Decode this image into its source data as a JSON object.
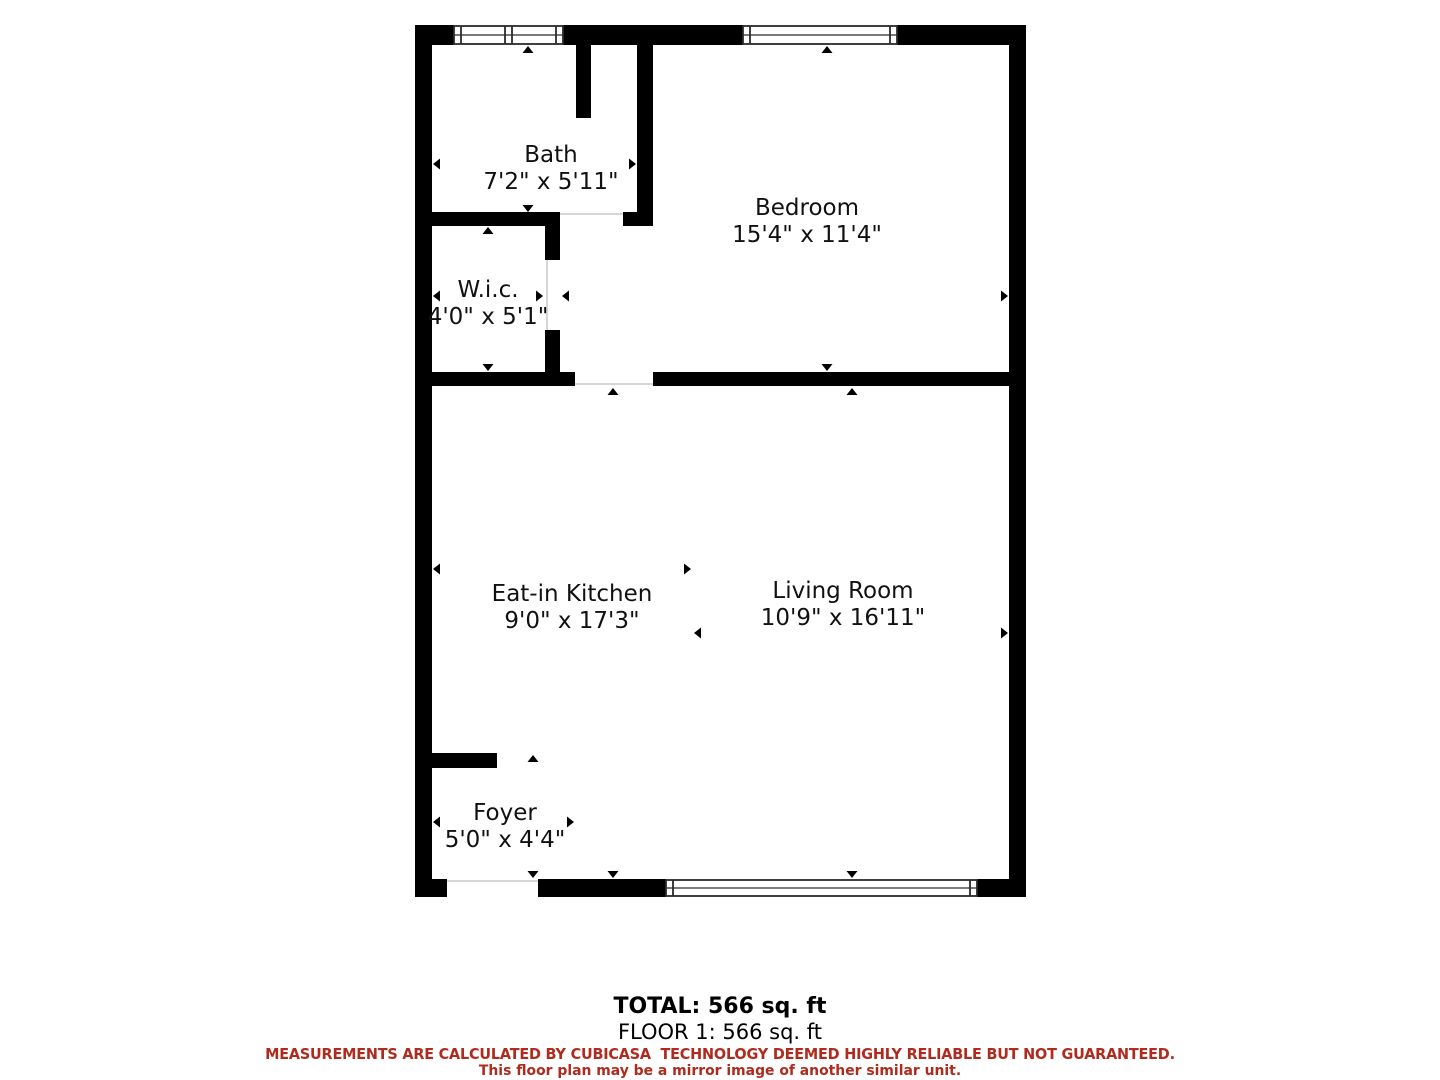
{
  "floorplan": {
    "colors": {
      "wall": "#000000",
      "background": "#ffffff",
      "window_line": "#2a2a2a",
      "disclaimer_red": "#b02a1e"
    },
    "rooms": [
      {
        "id": "bath",
        "name": "Bath",
        "dimensions": "7'2\" x 5'11\""
      },
      {
        "id": "bedroom",
        "name": "Bedroom",
        "dimensions": "15'4\" x 11'4\""
      },
      {
        "id": "wic",
        "name": "W.i.c.",
        "dimensions": "4'0\" x 5'1\""
      },
      {
        "id": "kitchen",
        "name": "Eat-in Kitchen",
        "dimensions": "9'0\" x 17'3\""
      },
      {
        "id": "living",
        "name": "Living Room",
        "dimensions": "10'9\" x 16'11\""
      },
      {
        "id": "foyer",
        "name": "Foyer",
        "dimensions": "5'0\" x 4'4\""
      }
    ]
  },
  "footer": {
    "total": "TOTAL: 566 sq. ft",
    "floor": "FLOOR 1: 566 sq. ft",
    "disclaimer_line1": "MEASUREMENTS ARE CALCULATED BY CUBICASA  TECHNOLOGY DEEMED HIGHLY RELIABLE BUT NOT GUARANTEED.",
    "disclaimer_line2": "This floor plan may be a mirror image of another similar unit."
  }
}
